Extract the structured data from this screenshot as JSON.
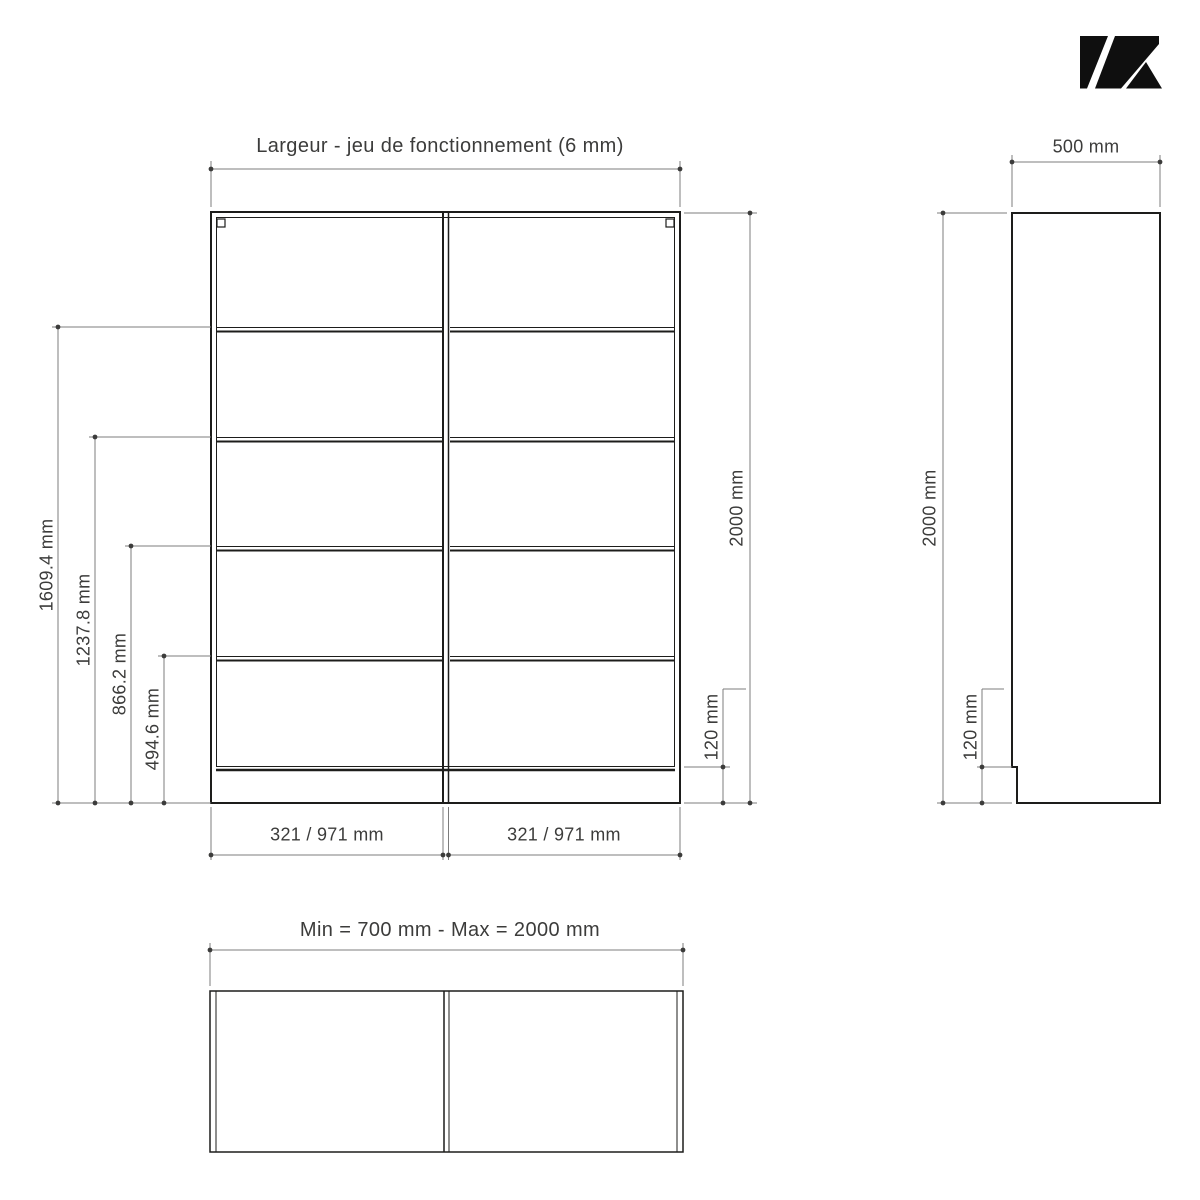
{
  "brand": {
    "logo_icon": "kazed-k-logo"
  },
  "front_view": {
    "title": "Largeur - jeu de fonctionnement (6 mm)",
    "dim_total_height": "2000 mm",
    "dim_plinth": "120 mm",
    "dim_shelves": [
      "1609.4 mm",
      "1237.8 mm",
      "866.2 mm",
      "494.6 mm"
    ],
    "dim_left_column": "321 / 971 mm",
    "dim_right_column": "321 / 971 mm"
  },
  "side_view": {
    "dim_depth": "500 mm",
    "dim_total_height": "2000 mm",
    "dim_plinth": "120 mm"
  },
  "top_view": {
    "title": "Min = 700 mm - Max = 2000 mm"
  },
  "colors": {
    "object_line": "#1d1d1b",
    "dimension_line": "#7c7c7c",
    "text": "#3c3c3b",
    "background": "#ffffff",
    "logo": "#0f0f0f"
  }
}
